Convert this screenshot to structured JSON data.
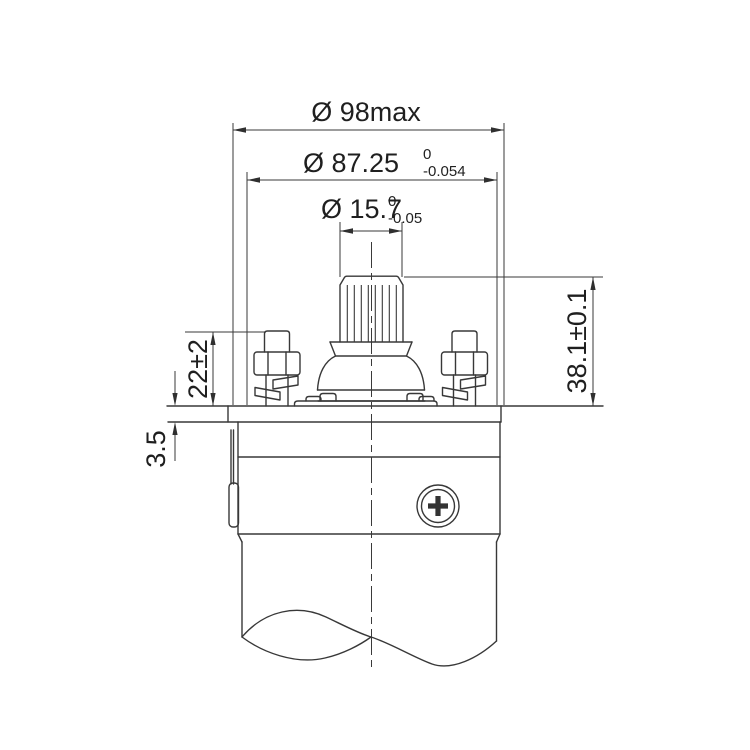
{
  "dimensions": {
    "overall_diameter": {
      "label": "Ø 98max"
    },
    "flange_diameter": {
      "label": "Ø 87.25",
      "tol_upper": "0",
      "tol_lower": "-0.054"
    },
    "shaft_diameter": {
      "label": "Ø 15.7",
      "tol_upper": "0",
      "tol_lower": "-0.05"
    },
    "shaft_height": {
      "label": "38.1±0.1"
    },
    "terminal_height": {
      "label": "22±2"
    },
    "flange_thickness": {
      "label": "3.5"
    }
  },
  "colors": {
    "line": "#383838",
    "text": "#1f1f1f",
    "background": "#ffffff"
  }
}
